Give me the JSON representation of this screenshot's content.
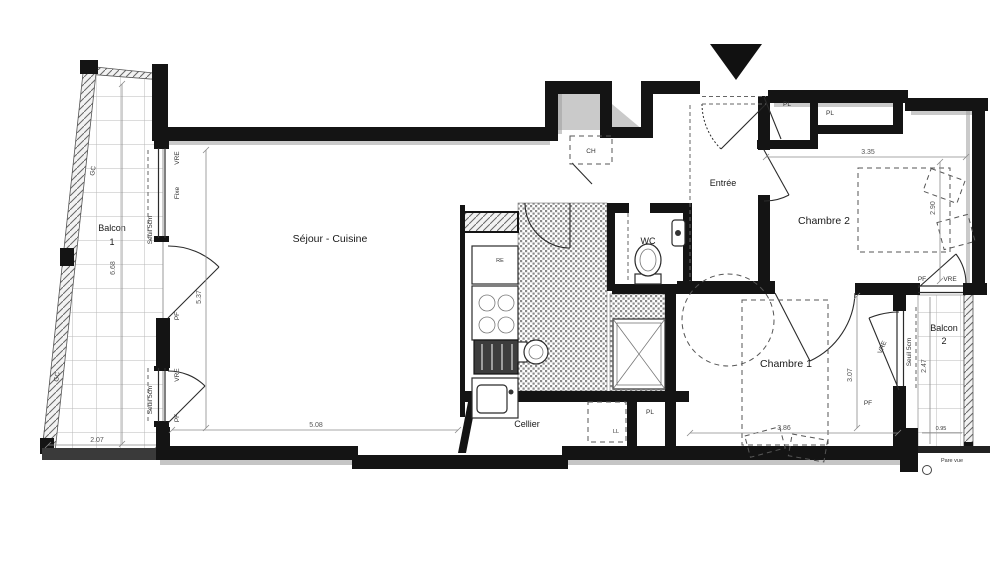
{
  "rooms": {
    "balcon1_line1": "Balcon",
    "balcon1_line2": "1",
    "sejour": "Séjour - Cuisine",
    "cellier": "Cellier",
    "entree": "Entrée",
    "wc": "WC",
    "chambre1": "Chambre 1",
    "chambre2": "Chambre 2",
    "balcon2_line1": "Balcon",
    "balcon2_line2": "2"
  },
  "fixtures": {
    "ch": "CH",
    "ll": "LL",
    "re": "RE",
    "pl": "PL"
  },
  "openings": {
    "vre": "VRE",
    "fixe": "Fixe",
    "pf": "PF",
    "seuil": "Seuil 5cm",
    "gc": "GC",
    "pare_vue": "Pare vue"
  },
  "dimensions": {
    "balcon1_length": "6.68",
    "balcon1_width": "2.07",
    "sejour_length": "5.37",
    "sejour_width": "5.08",
    "chambre2_width": "3.35",
    "chambre2_length": "2.90",
    "chambre1_width": "3.86",
    "chambre1_length": "3.07",
    "balcon2_length": "2.47",
    "balcon2_width": "0.95"
  },
  "colors": {
    "wall": "#141414",
    "hatch_dot": "#8a8a8a",
    "tile_line": "#b9b9b9"
  }
}
